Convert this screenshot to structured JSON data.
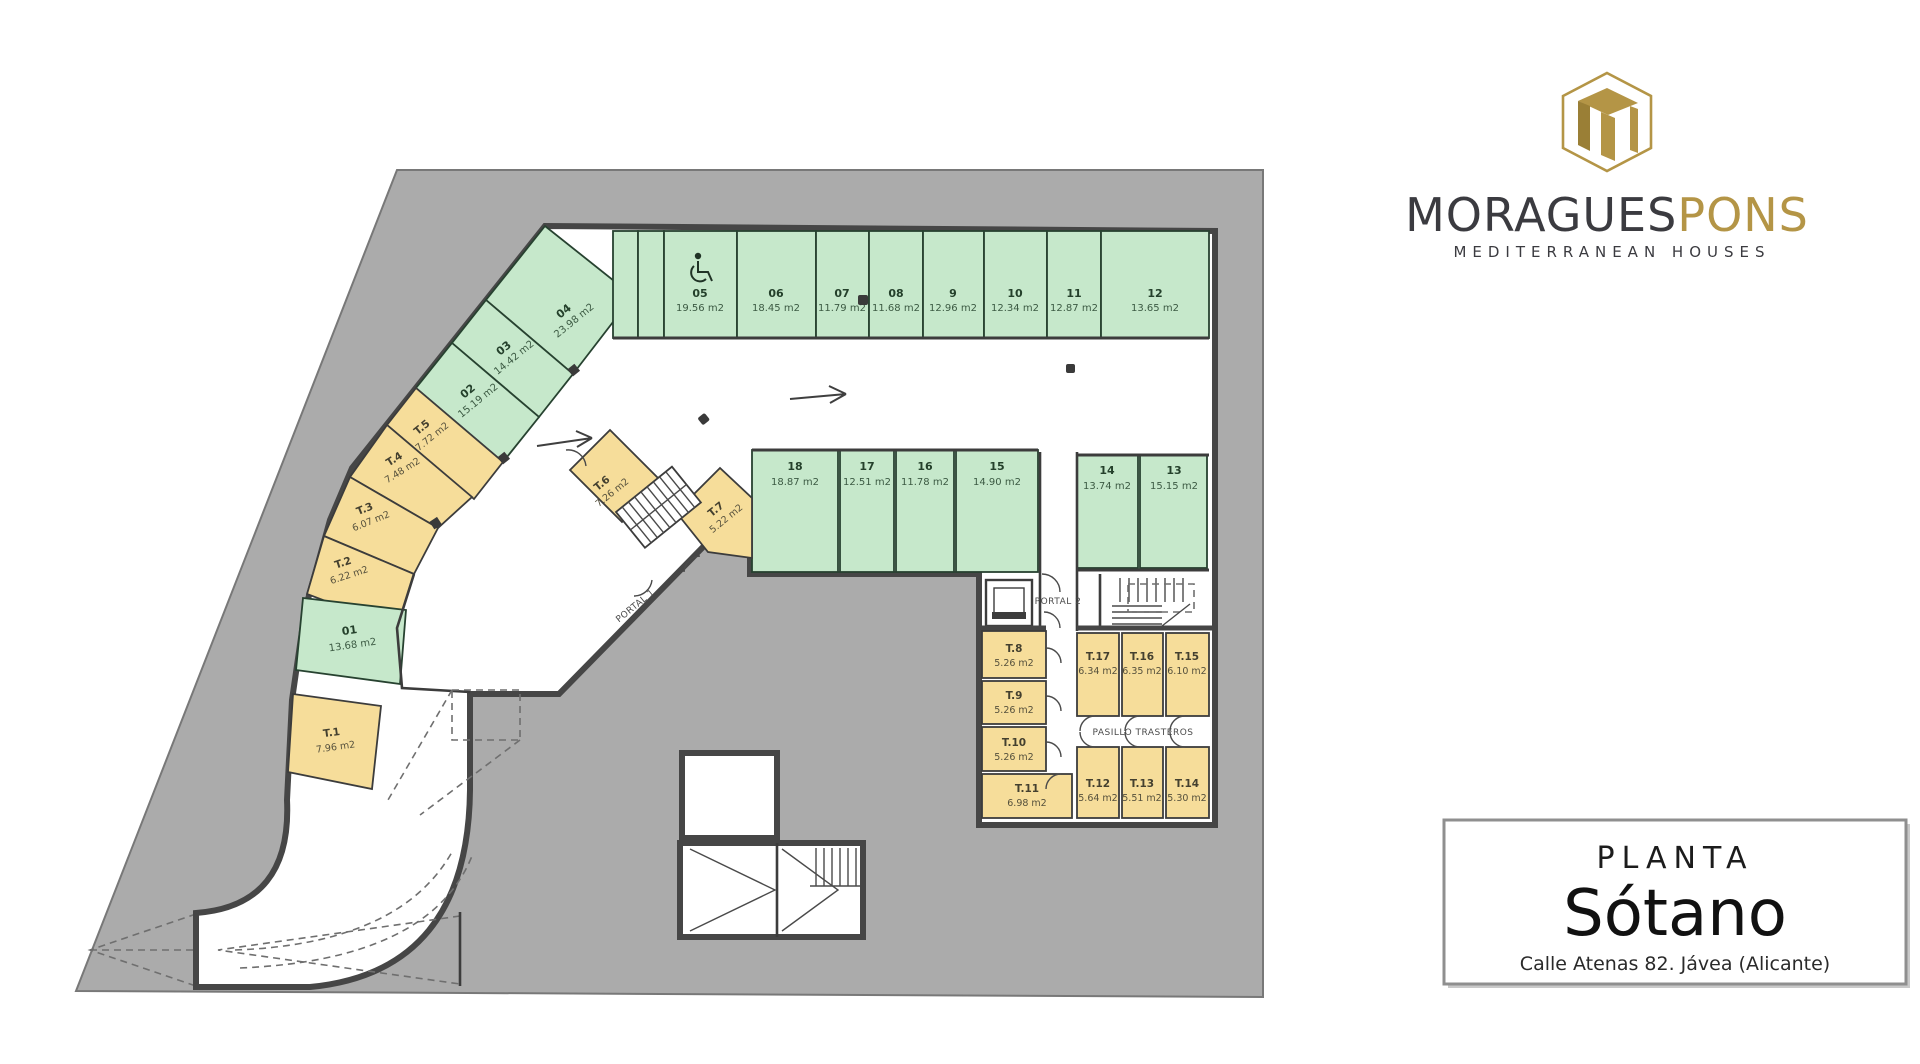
{
  "brand": {
    "logo_text_dark": "MORAGUES",
    "logo_text_gold": "PONS",
    "tagline": "MEDITERRANEAN HOUSES"
  },
  "title_block": {
    "label": "PLANTA",
    "name": "Sótano",
    "address": "Calle Atenas 82. Jávea (Alicante)"
  },
  "floor_plan": {
    "labels": {
      "portal_1": "PORTAL 1",
      "portal_2": "PORTAL 2",
      "corridor": "PASILLO TRASTEROS"
    },
    "parking_top_row": [
      {
        "id": "05",
        "area": "19.56 m2"
      },
      {
        "id": "06",
        "area": "18.45 m2"
      },
      {
        "id": "07",
        "area": "11.79 m2"
      },
      {
        "id": "08",
        "area": "11.68 m2"
      },
      {
        "id": "9",
        "area": "12.96 m2"
      },
      {
        "id": "10",
        "area": "12.34 m2"
      },
      {
        "id": "11",
        "area": "12.87 m2"
      },
      {
        "id": "12",
        "area": "13.65 m2"
      }
    ],
    "parking_mid_row": [
      {
        "id": "18",
        "area": "18.87 m2"
      },
      {
        "id": "17",
        "area": "12.51 m2"
      },
      {
        "id": "16",
        "area": "11.78 m2"
      },
      {
        "id": "15",
        "area": "14.90 m2"
      },
      {
        "id": "14",
        "area": "13.74 m2"
      },
      {
        "id": "13",
        "area": "15.15 m2"
      }
    ],
    "parking_diagonal": [
      {
        "id": "04",
        "area": "23.98 m2"
      },
      {
        "id": "03",
        "area": "14.42 m2"
      },
      {
        "id": "02",
        "area": "15.19 m2"
      },
      {
        "id": "01",
        "area": "13.68 m2"
      }
    ],
    "storage_rooms": [
      {
        "id": "T.1",
        "area": "7.96 m2"
      },
      {
        "id": "T.2",
        "area": "6.22 m2"
      },
      {
        "id": "T.3",
        "area": "6.07 m2"
      },
      {
        "id": "T.4",
        "area": "7.48 m2"
      },
      {
        "id": "T.5",
        "area": "7.72 m2"
      },
      {
        "id": "T.6",
        "area": "7.26 m2"
      },
      {
        "id": "T.7",
        "area": "5.22 m2"
      },
      {
        "id": "T.8",
        "area": "5.26 m2"
      },
      {
        "id": "T.9",
        "area": "5.26 m2"
      },
      {
        "id": "T.10",
        "area": "5.26 m2"
      },
      {
        "id": "T.11",
        "area": "6.98 m2"
      },
      {
        "id": "T.12",
        "area": "5.64 m2"
      },
      {
        "id": "T.13",
        "area": "5.51 m2"
      },
      {
        "id": "T.14",
        "area": "5.30 m2"
      },
      {
        "id": "T.15",
        "area": "6.10 m2"
      },
      {
        "id": "T.16",
        "area": "6.35 m2"
      },
      {
        "id": "T.17",
        "area": "6.34 m2"
      }
    ],
    "colors": {
      "parking": "#c6e8cb",
      "storage": "#f6dd9a",
      "lot": "#ababab",
      "wall": "#464646",
      "gold": "#b49546"
    }
  }
}
